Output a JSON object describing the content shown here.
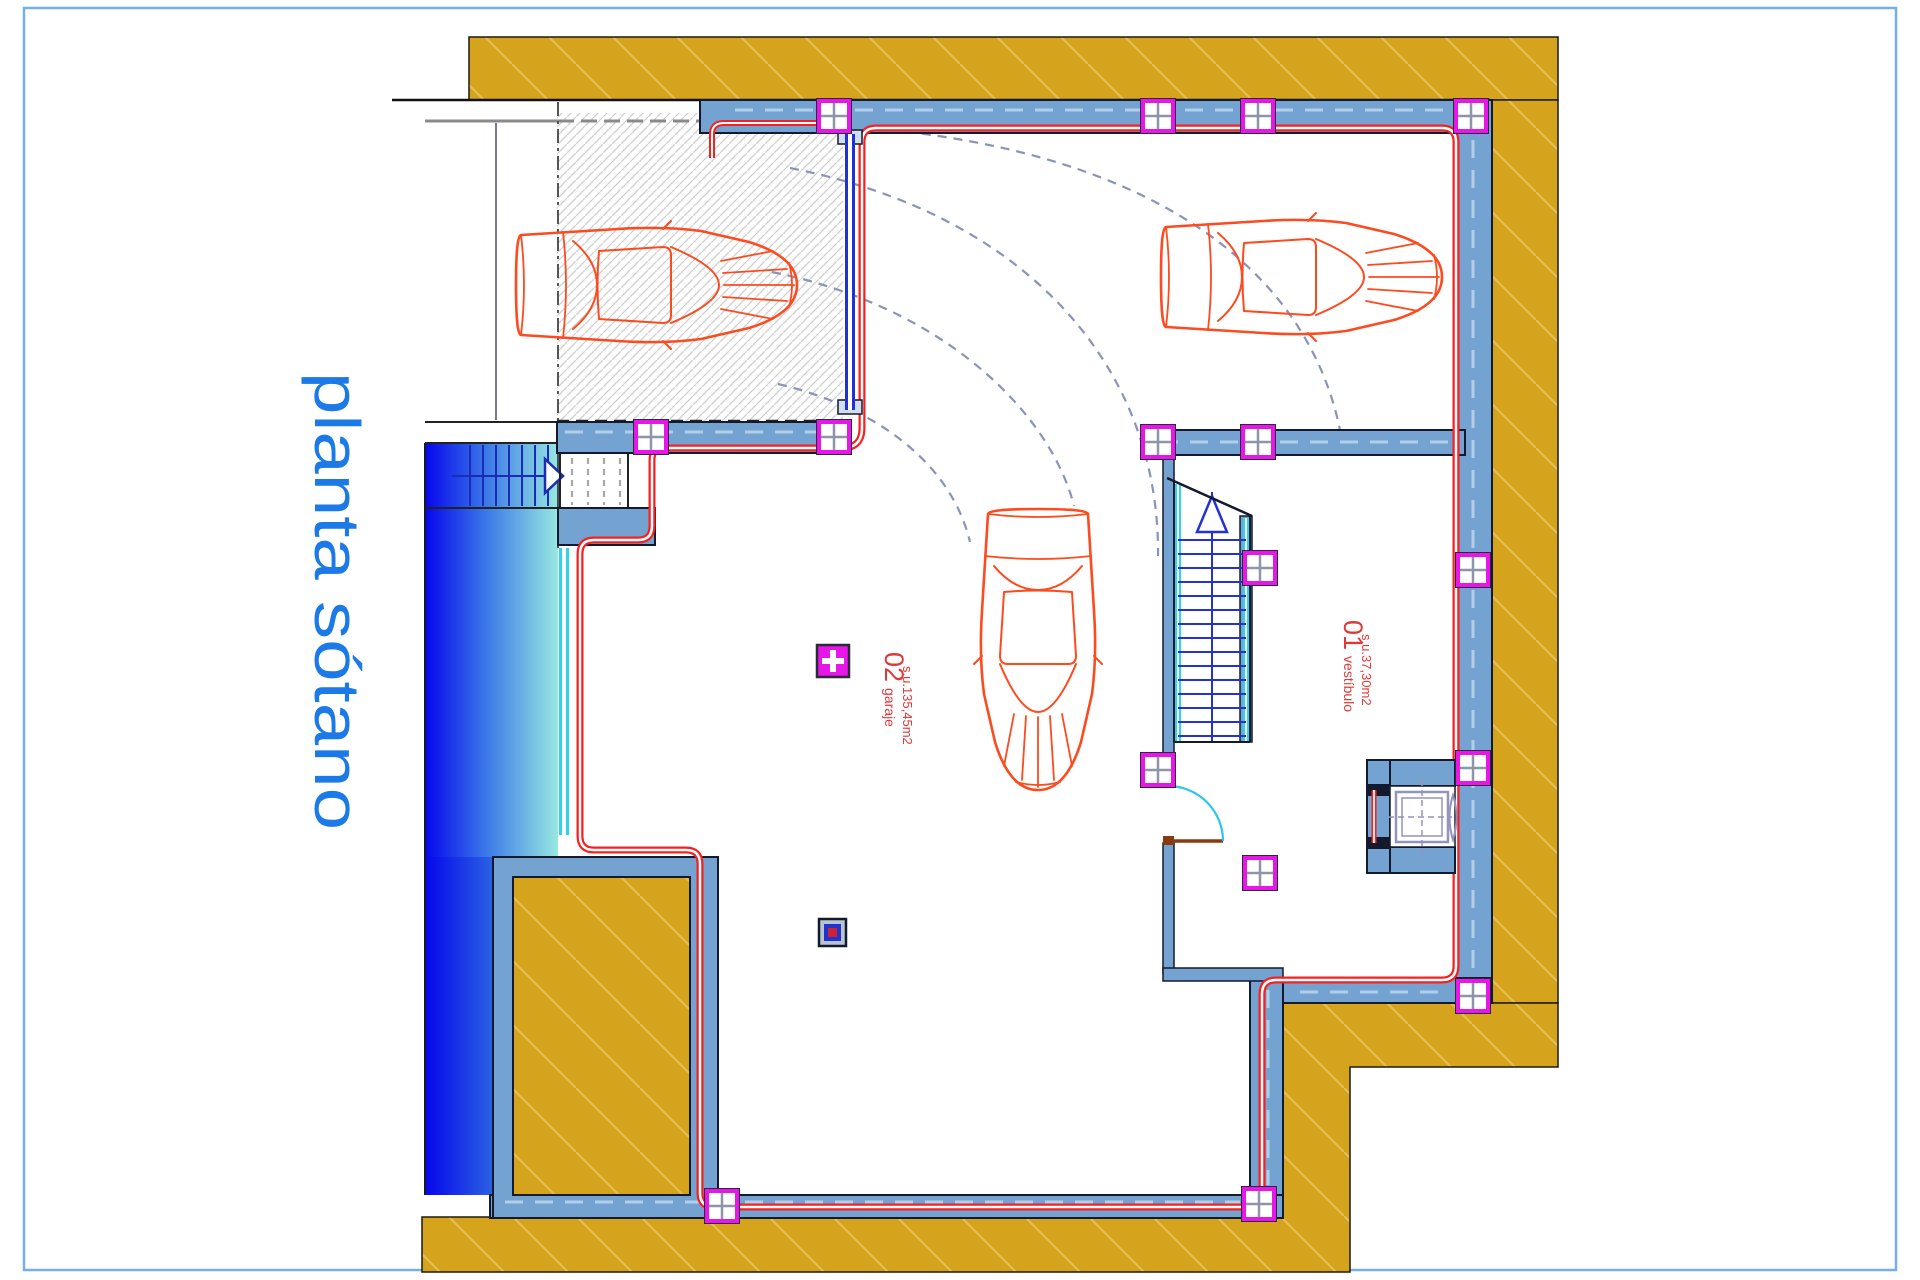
{
  "page": {
    "background_color": "#ffffff",
    "border_color": "#79aee3"
  },
  "title": {
    "text": "planta sótano",
    "color": "#1b79e8"
  },
  "rooms": [
    {
      "number": "02",
      "name": "garaje",
      "area_label": "s.u.135,45m2",
      "label_color": "#e03838"
    },
    {
      "number": "01",
      "name": "vestíbulo",
      "area_label": "s.u.37,30m2",
      "label_color": "#e03838"
    }
  ],
  "counts": {
    "cars": 3,
    "staircases": 2,
    "elevators": 1
  },
  "palette": {
    "retaining_wall_gold": "#d6a41c",
    "wall_fill_blue": "#74a3d2",
    "insulation_red": "#f52020",
    "column_magenta": "#e816e8",
    "pool_gradient_start": "#0606ec",
    "pool_gradient_end": "#97e8e0",
    "car_outline": "#fd4a1e",
    "garage_door_blue": "#2230d8",
    "glass_cyan": "#2bd5ee",
    "stair_tread_blue": "#2331d6",
    "door_swing_cyan": "#2bc6e8",
    "elevator_gray": "#9393bd",
    "turning_arc_gray": "#8a93b8"
  },
  "icons": {
    "exterior_stair_arrow": "right-arrow",
    "vestibule_stair_arrow": "up-arrow",
    "elevator_door": "lens"
  }
}
